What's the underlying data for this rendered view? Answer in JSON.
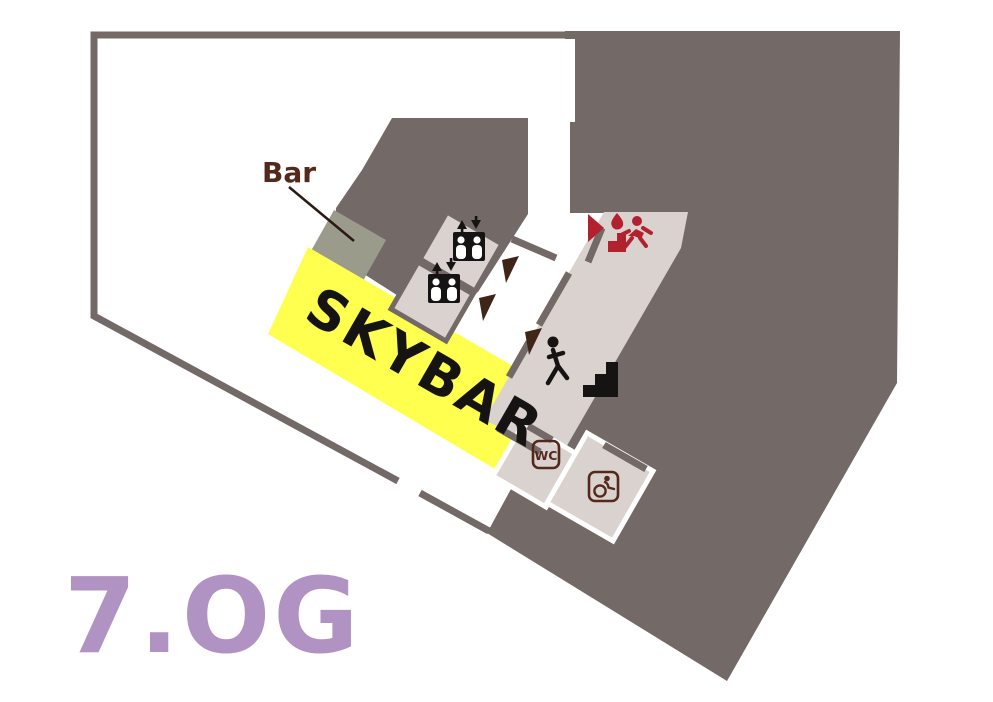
{
  "page": {
    "type": "building-floor-plan",
    "floor_label": "7.OG"
  },
  "labels": {
    "floor": "7.OG",
    "skybar": "SKYBAR",
    "bar": "Bar",
    "wc": "WC"
  },
  "icons": {
    "elevator_upper": "elevator-pictogram-with-up-down-arrows",
    "elevator_lower": "elevator-pictogram-with-up-down-arrows",
    "emergency_exit": "emergency-exit-stairs-with-flame",
    "exit_direction": "red-arrow-right",
    "stairs": "person-on-stairs",
    "wheelchair": "accessible-wc-sign",
    "door_markers": [
      "door-cone-1",
      "door-cone-2",
      "door-cone-3"
    ]
  },
  "colors": {
    "wall_gray": "#736a67",
    "room_light": "#d9d2cf",
    "bar_counter_gray": "#9b9b8b",
    "skybar_yellow": "#feff4f",
    "door_cone_brown": "#3f2517",
    "label_maroon": "#53291c",
    "emergency_red": "#b2212e",
    "floor_purple": "#b193c3",
    "text_black": "#161412",
    "background": "#ffffff"
  }
}
